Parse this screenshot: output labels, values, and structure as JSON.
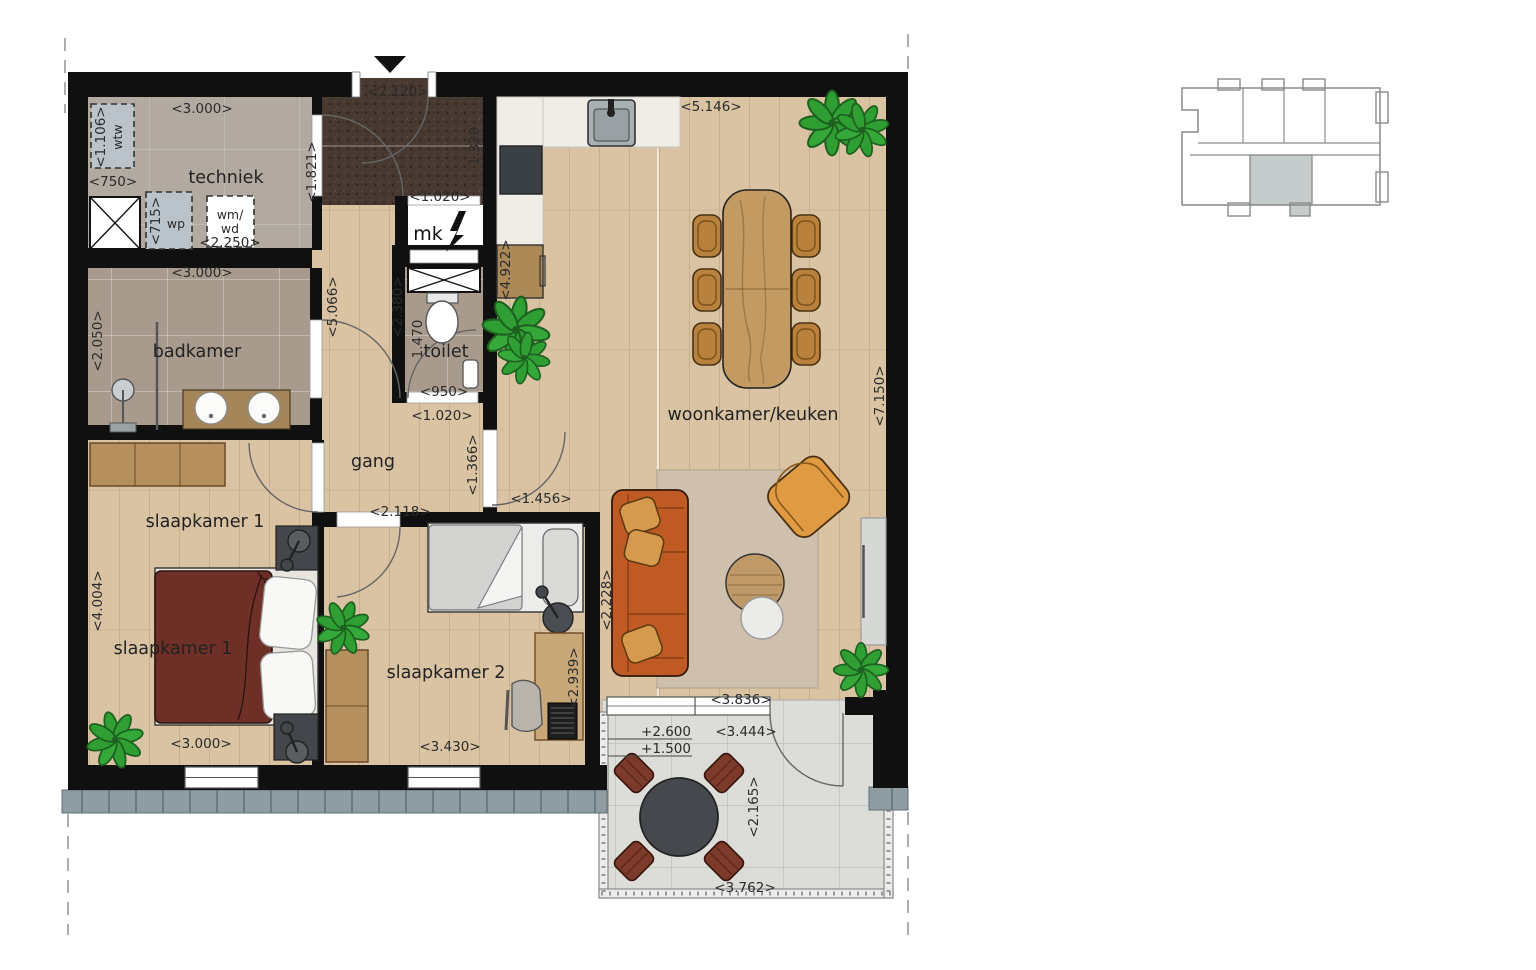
{
  "plan": {
    "rooms": {
      "techniek": "techniek",
      "badkamer": "badkamer",
      "toilet": "toilet",
      "gang": "gang",
      "woonkamer": "woonkamer/keuken",
      "slaapkamer1_a": "slaapkamer 1",
      "slaapkamer1_b": "slaapkamer 1",
      "slaapkamer2": "slaapkamer 2"
    },
    "units": {
      "mk": "mk",
      "wtw": "wtw",
      "wp": "wp",
      "wmwd_line1": "wm/",
      "wmwd_line2": "wd"
    },
    "dims": {
      "techniek_w": "<3.000>",
      "wtw_h": "<1.106>",
      "wtw_w": "<750>",
      "wp_h": "<715>",
      "wmwd_w": "<2.250>",
      "entree_w": "<2.120>",
      "entree_left": "<1.821>",
      "entree_right": "1.320",
      "mk_w": "<1.020>",
      "badkamer_w": "<3.000>",
      "badkamer_h": "<2.050>",
      "gang_h": "<5.066>",
      "gang_h2": "<2.380>",
      "toilet_h": "1.470",
      "toilet_w": "<950>",
      "toilet_w2": "<1.020>",
      "keuken_w": "<5.146>",
      "keuken_h": "<4.922>",
      "woonkamer_h": "<7.150>",
      "woonkamer_door": "<1.366>",
      "woonkamer_w2": "<1.456>",
      "slaap2_door": "<2.118>",
      "slaap1_h": "<4.004>",
      "slaap1_w": "<3.000>",
      "slaap2_w": "<3.430>",
      "slaap2_h": "<2.939>",
      "sofa_wall": "<2.228>",
      "rug_w": "<3.836>",
      "balkon_level_a": "+2.600",
      "balkon_level_b": "+1.500",
      "balkon_w": "<3.444>",
      "balkon_h": "<2.165>",
      "balkon_w2": "<3.762>"
    },
    "colors": {
      "wall": "#101010",
      "wood_floor": "#d9c3a3",
      "tile_floor": "#a89b8d",
      "concrete_floor": "#b2a9a1",
      "entrance_mat": "#473830",
      "balcony_floor": "#dcdcd8",
      "facade": "#8f9da3",
      "sofa": "#bf5a24",
      "armchair": "#e09a42",
      "bed1_duvet": "#6d2f26",
      "minimap_highlight": "#c6cccb",
      "plant": "#2f9e33"
    }
  }
}
